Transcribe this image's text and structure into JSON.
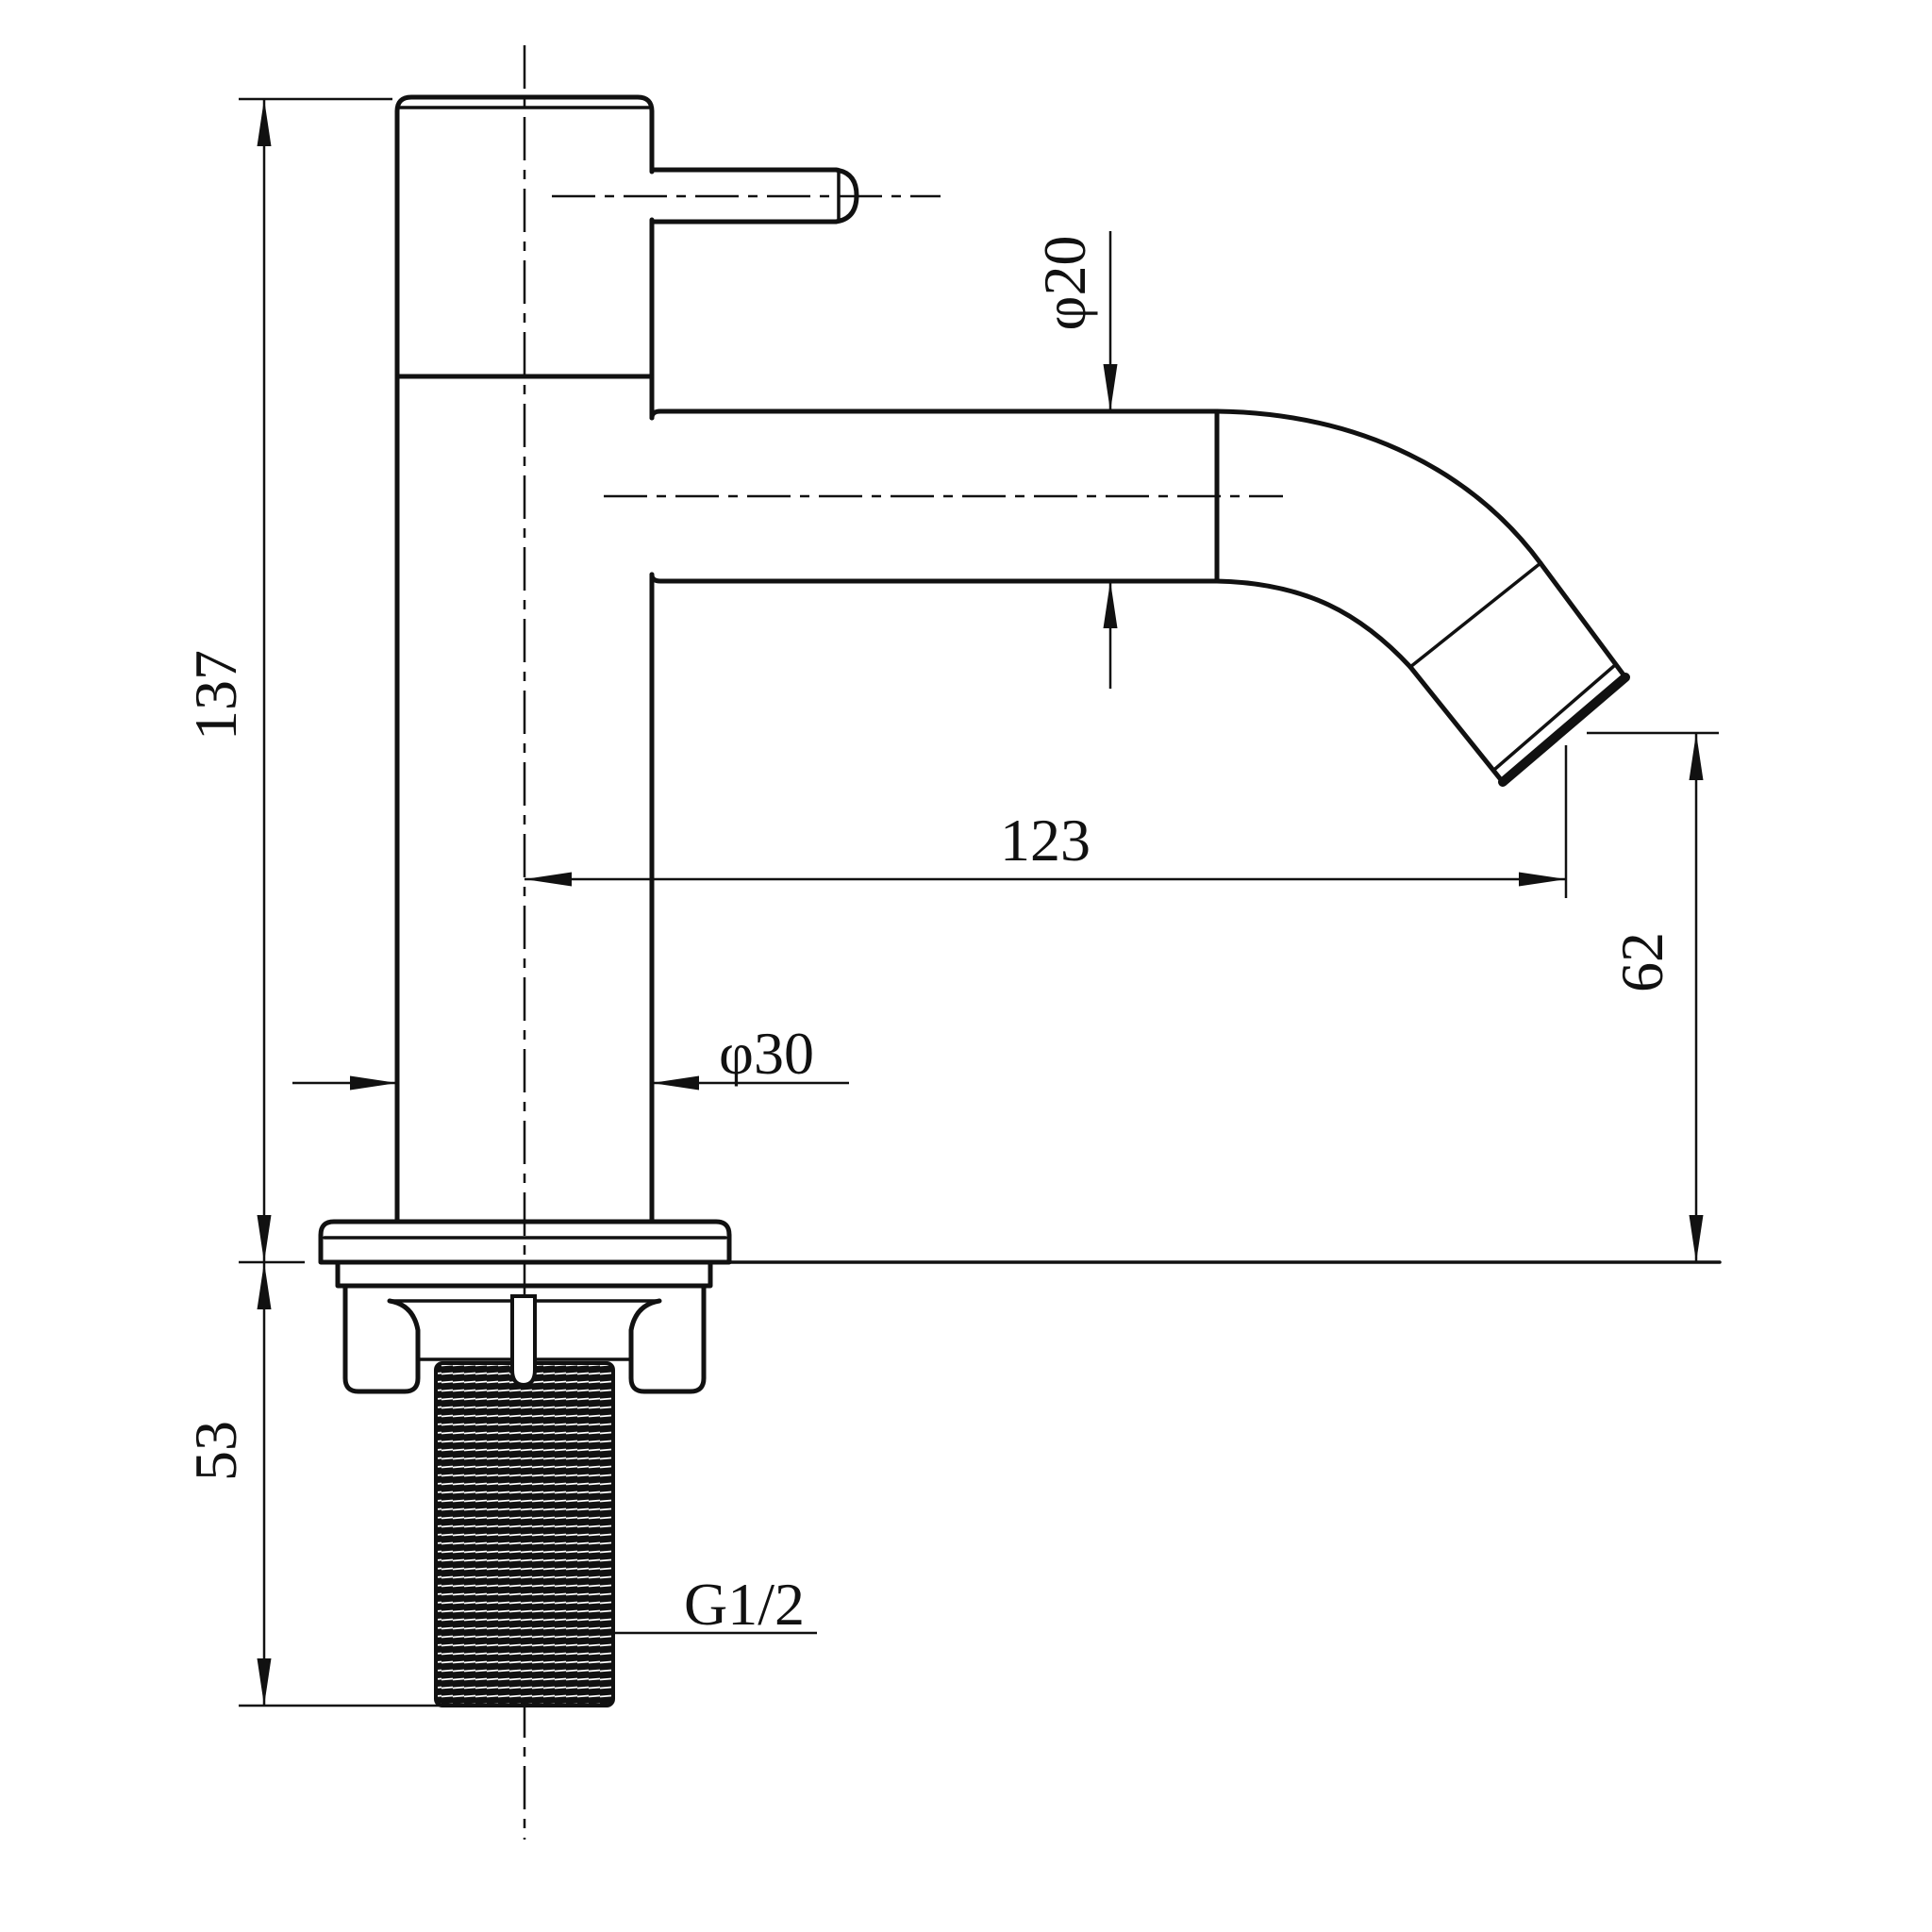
{
  "meta": {
    "drawing_type": "faucet-technical-drawing",
    "background_color": "#ffffff",
    "line_color": "#111111"
  },
  "labels": {
    "total_height": "137",
    "shank_length": "53",
    "spout_reach": "123",
    "outlet_height": "62",
    "body_diameter": "φ30",
    "spout_diameter": "φ20",
    "thread": "G1/2"
  }
}
